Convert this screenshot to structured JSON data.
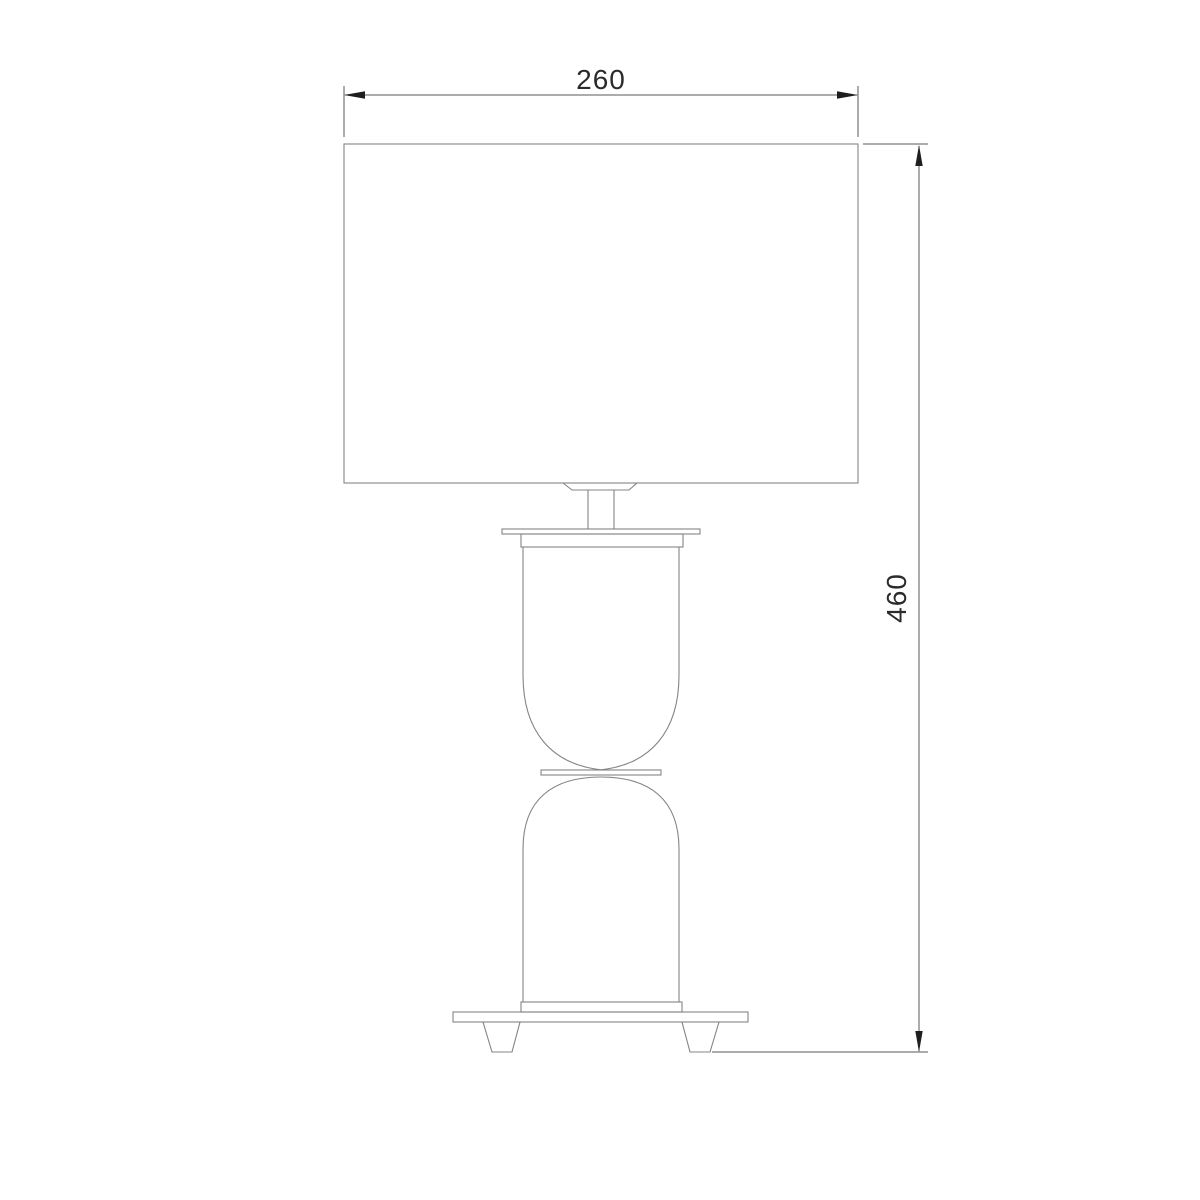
{
  "drawing": {
    "type": "technical-dimension-drawing",
    "subject": "table-lamp-front-elevation",
    "dimensions": {
      "width_label": "260",
      "height_label": "460"
    },
    "colors": {
      "background": "#ffffff",
      "geometry_line": "#848484",
      "dimension_line": "#5a5a5a",
      "arrow": "#1e1e1e",
      "label_text": "#2b2b2b"
    }
  }
}
